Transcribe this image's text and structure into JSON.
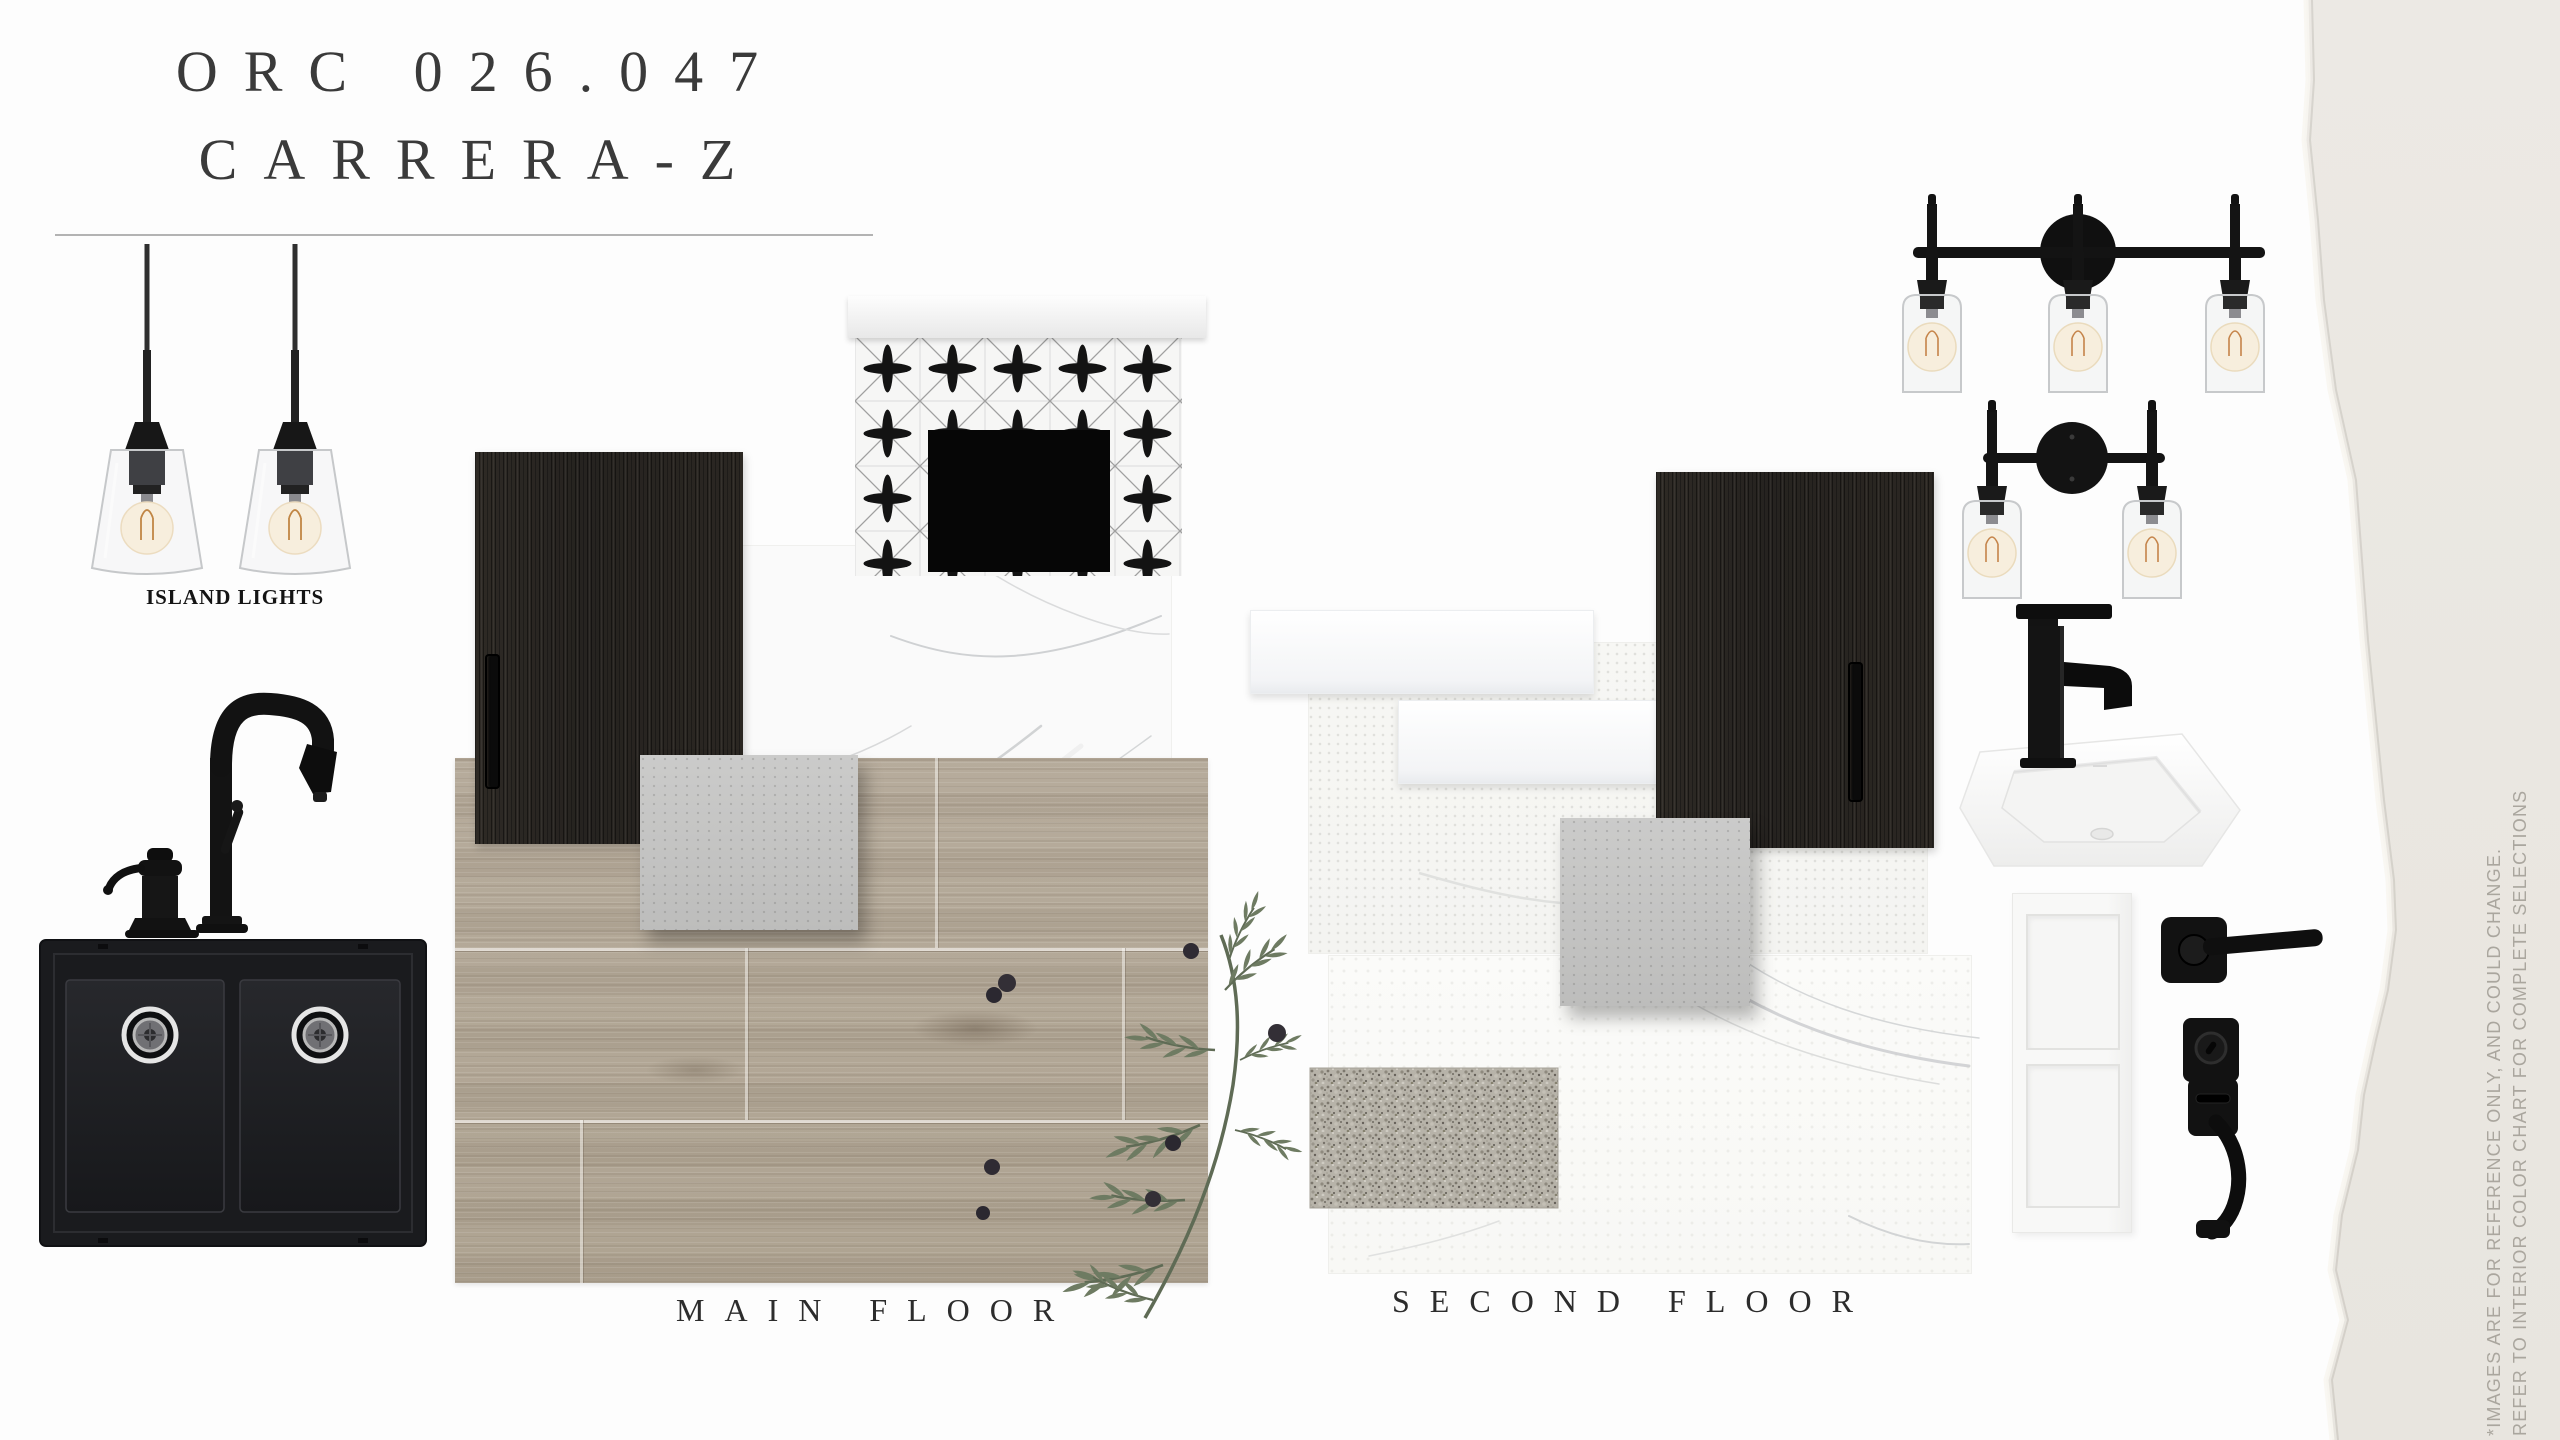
{
  "header": {
    "title_line1": "ORC 026.047",
    "title_line2": "CARRERA-Z"
  },
  "labels": {
    "island_lights": "ISLAND LIGHTS",
    "main_floor": "MAIN FLOOR",
    "second_floor": "SECOND FLOOR"
  },
  "disclaimer": {
    "line1": "*IMAGES ARE FOR REFERENCE ONLY, AND COULD CHANGE.",
    "line2": "REFER TO INTERIOR COLOR CHART FOR COMPLETE SELECTIONS"
  },
  "colors": {
    "background": "#fdfdfd",
    "paper_tear": "#eae7e1",
    "title_text": "#3a3a3a",
    "label_text": "#2c2c2c",
    "disclaimer_text": "#aaa69e",
    "fixture_black": "#141414",
    "cabinet_dark": "#262320",
    "wood_floor": "#b6ab9b",
    "tile_gray": "#cbcbca",
    "granite_gray": "#b7b3a9",
    "marble_white": "#fafafa",
    "bulb_warm": "#f7eedd",
    "olive_green": "#6e7b62"
  }
}
